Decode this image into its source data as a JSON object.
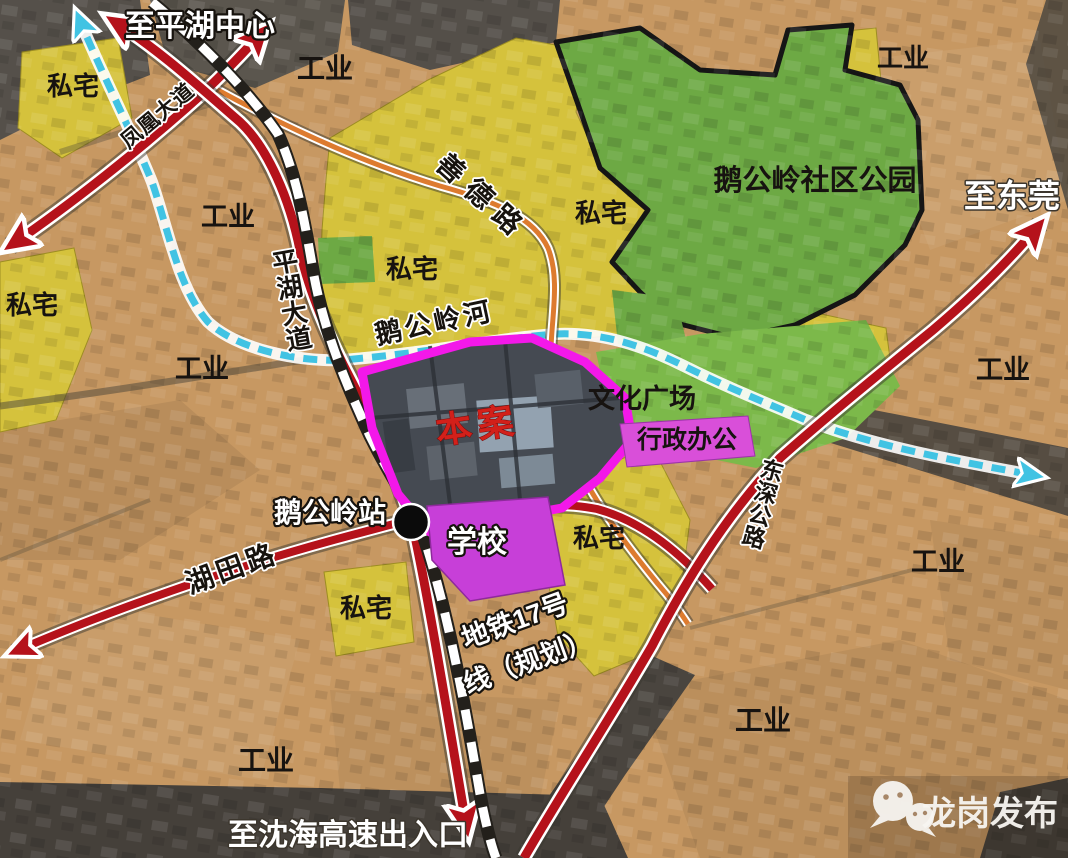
{
  "map": {
    "destinations": {
      "pinghu_center": "至平湖中心",
      "dongguan": "至东莞",
      "shenhai_expressway": "至沈海高速出入口"
    },
    "roads": {
      "pinghu_avenue": "平湖大道",
      "fenghuang_avenue": "凤凰大道",
      "shande_road": "善德路",
      "hutian_road": "湖田路",
      "dongshen_highway": "东深公路"
    },
    "river": "鹅公岭河",
    "metro": {
      "full": "地铁17号线（规划）",
      "line1": "地铁17号",
      "line2": "线（规划）"
    },
    "station": "鹅公岭站",
    "site": "本案",
    "zones": {
      "industrial": "工业",
      "residential": "私宅",
      "park": "鹅公岭社区公园",
      "culture_plaza": "文化广场",
      "admin_office": "行政办公",
      "school": "学校"
    },
    "watermark": "龙岗发布",
    "colors": {
      "industrial_tan": "#c79862",
      "residential_yellow": "#d5c23c",
      "park_green": "#6da944",
      "plaza_green": "#7cb94a",
      "school_fill": "#c73fd8",
      "admin_fill": "#d94fd9",
      "site_outline": "#f318e9",
      "site_label_red": "#d2201a",
      "road_red": "#b5121b",
      "road_orange": "#dd7b2f",
      "river_cyan": "#41c3e3",
      "metro_dash": "#ffffff"
    }
  }
}
